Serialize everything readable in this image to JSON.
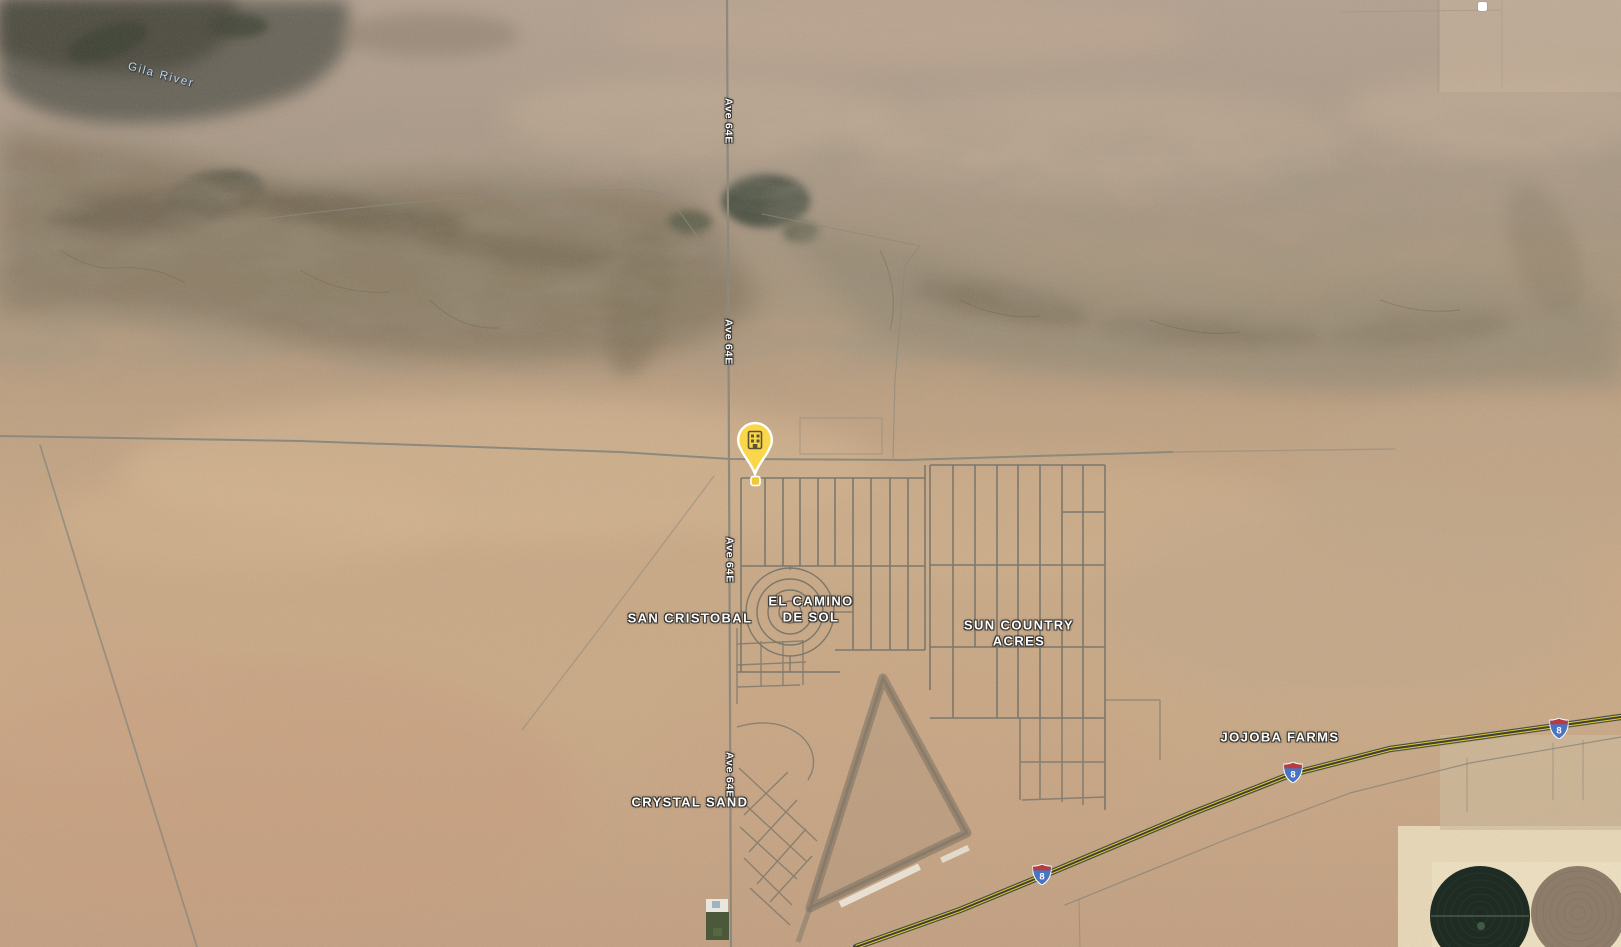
{
  "map": {
    "type": "satellite",
    "description": "Google Maps satellite view of desert land near Gila River with rural subdivisions and Interstate 8"
  },
  "labels": {
    "river": "Gila River",
    "road_ave64e": "Ave 64E",
    "san_cristobal": "SAN CRISTOBAL",
    "el_camino_de_sol": "EL CAMINO\nDE SOL",
    "sun_country_acres": "SUN COUNTRY\nACRES",
    "jojoba_farms": "JOJOBA FARMS",
    "crystal_sand": "CRYSTAL SAND"
  },
  "highway": {
    "shield_text": "8",
    "shield_blue": "#4a73c0",
    "shield_red": "#bb3a3e"
  },
  "marker": {
    "icon": "building-icon",
    "pin_color": "#f9d64a",
    "glyph_color": "#5e5233"
  },
  "colors": {
    "label_text": "#fdfdfd",
    "river_label": "#bdd4ec",
    "road_line": "#8d897d",
    "highway_stripe": "#d9c435",
    "sand": "#c9ab8b",
    "mountain": "#6a675a",
    "field_cream": "#e9d9ba",
    "crop_circle_dark": "#1f2c24",
    "crop_circle_brown": "#8d7c69"
  }
}
